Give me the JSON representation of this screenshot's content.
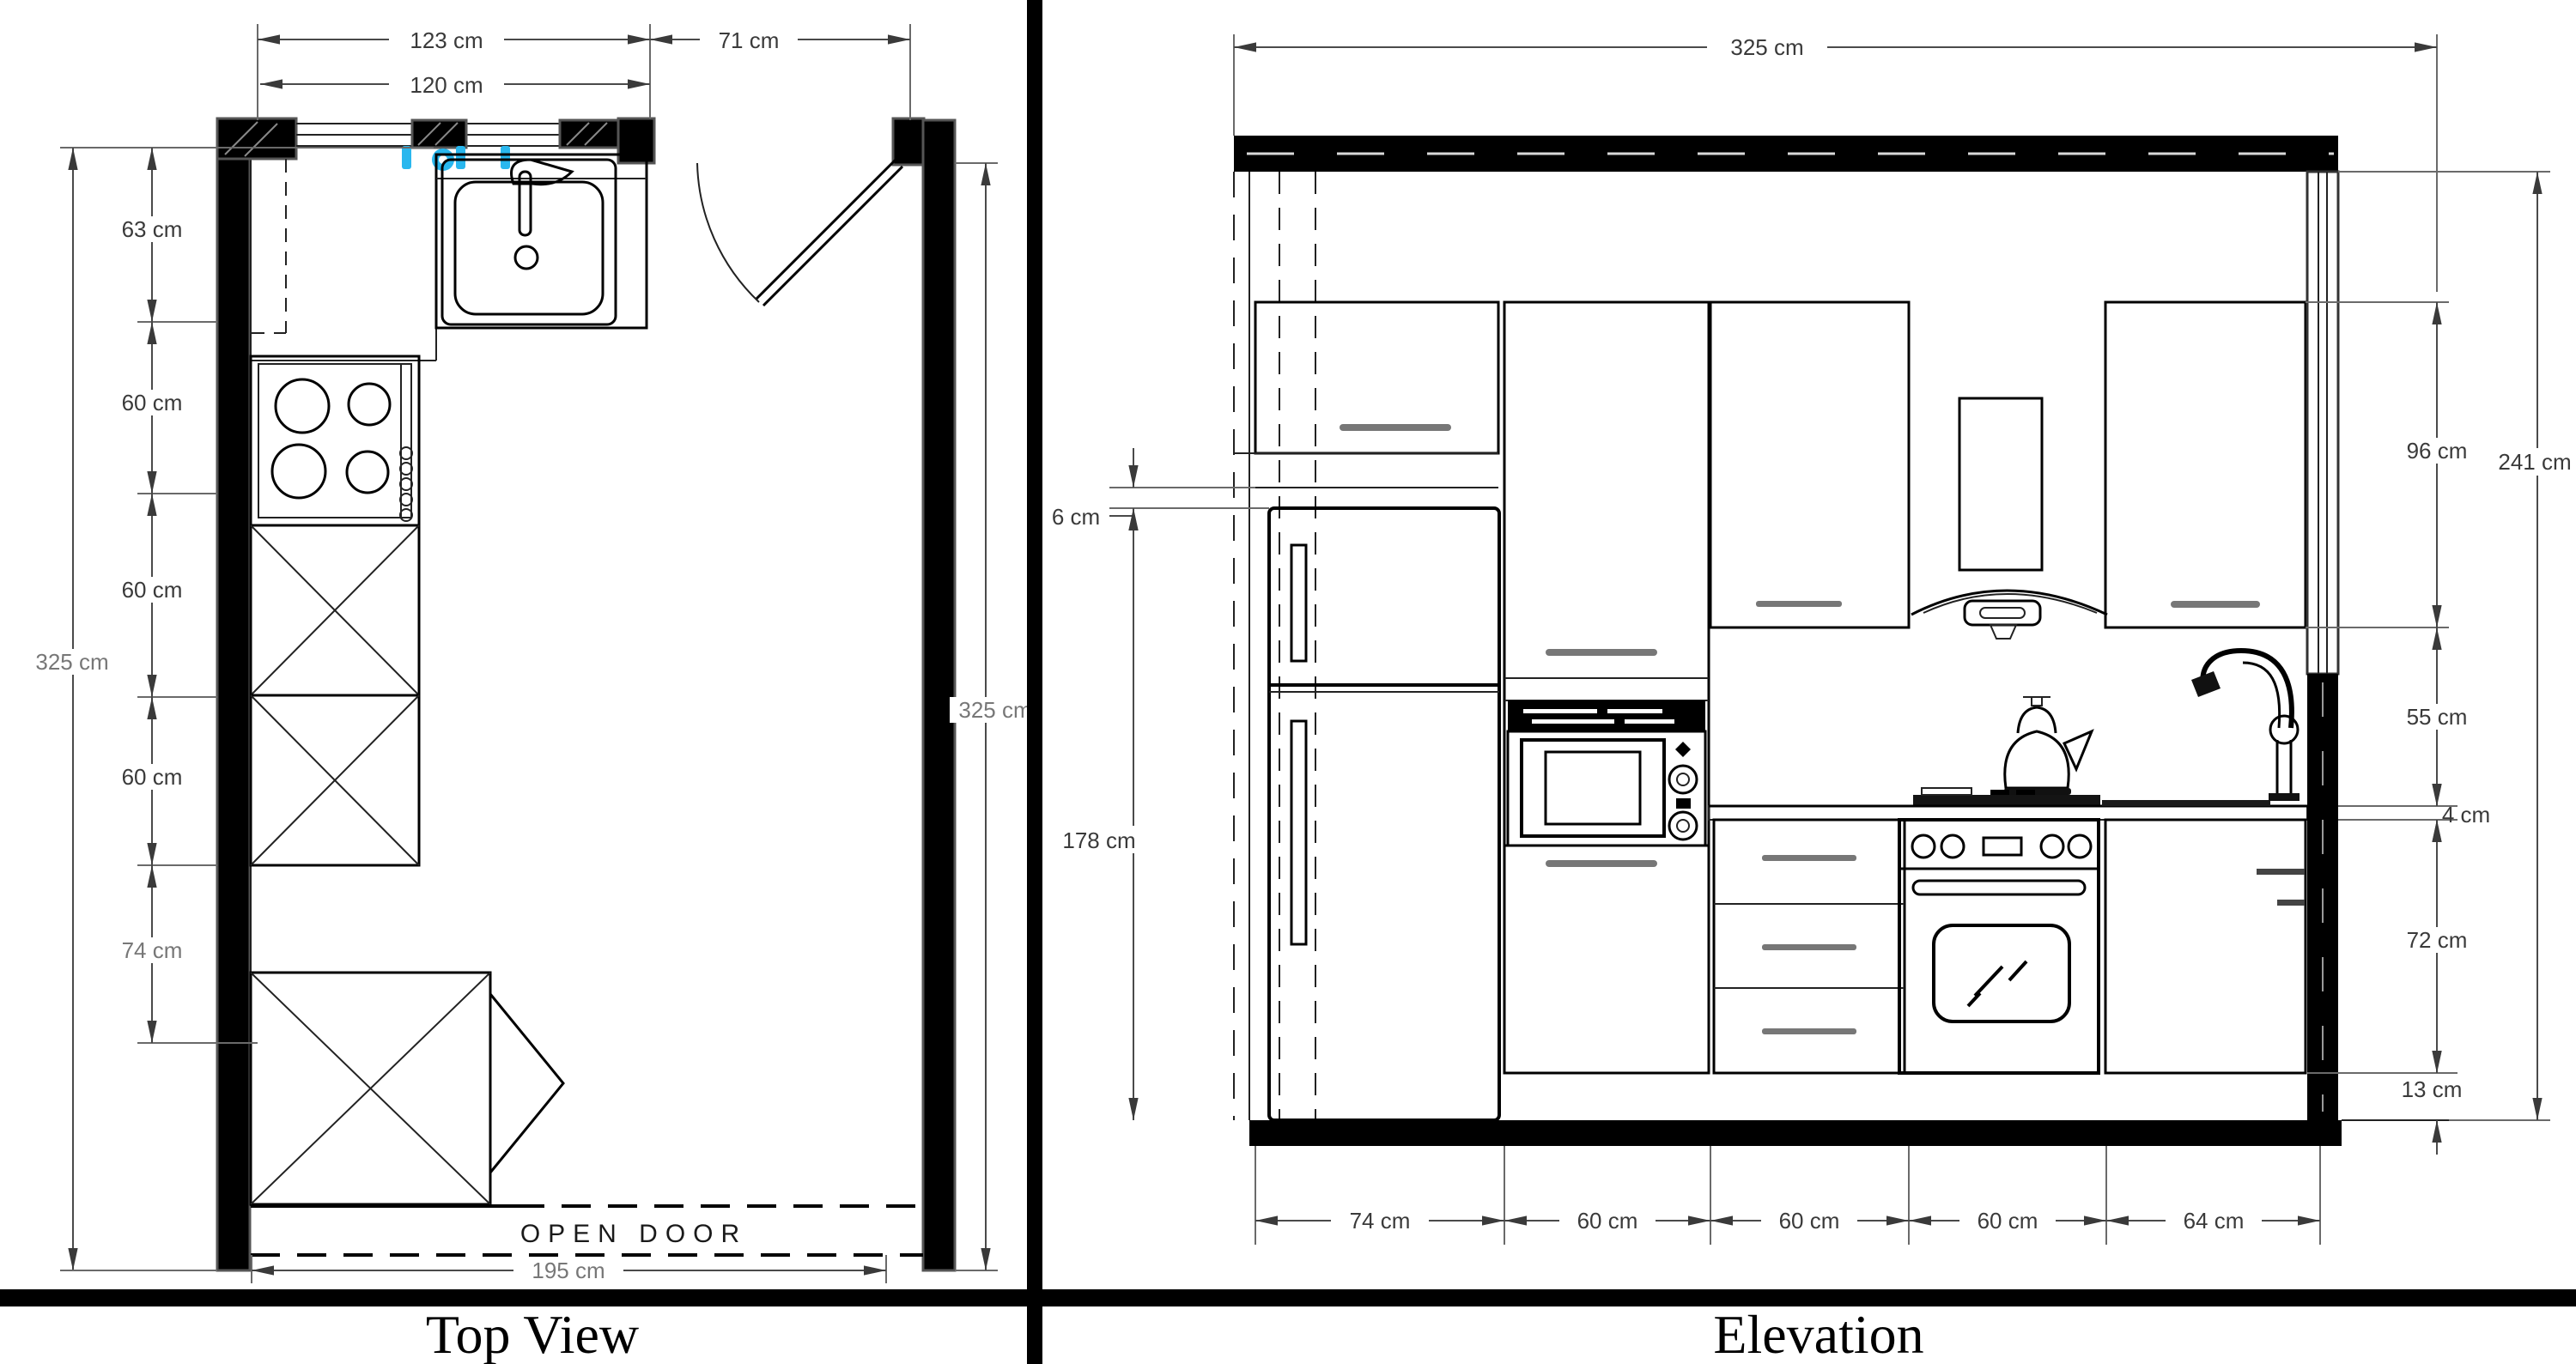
{
  "panels": {
    "top_view": {
      "title": "Top View",
      "dims": {
        "d123": "123 cm",
        "d120": "120 cm",
        "d71": "71 cm",
        "d63": "63 cm",
        "d60a": "60 cm",
        "d60b": "60 cm",
        "d60c": "60 cm",
        "d74": "74 cm",
        "d325_left": "325 cm",
        "d325_right": "325 cm",
        "d195": "195 cm"
      },
      "annotations": {
        "open_door": "OPEN DOOR"
      }
    },
    "elevation": {
      "title": "Elevation",
      "dims": {
        "d325": "325 cm",
        "d96": "96 cm",
        "d55": "55 cm",
        "d4": "4 cm",
        "d72": "72 cm",
        "d13": "13 cm",
        "d241": "241 cm",
        "d6": "6 cm",
        "d178": "178 cm",
        "d74": "74 cm",
        "d60a": "60 cm",
        "d60b": "60 cm",
        "d60c": "60 cm",
        "d64": "64 cm"
      }
    }
  },
  "colors": {
    "outlet_accent": "#29b7ee",
    "line": "#000000",
    "dim_text": "#3a3a3a"
  }
}
